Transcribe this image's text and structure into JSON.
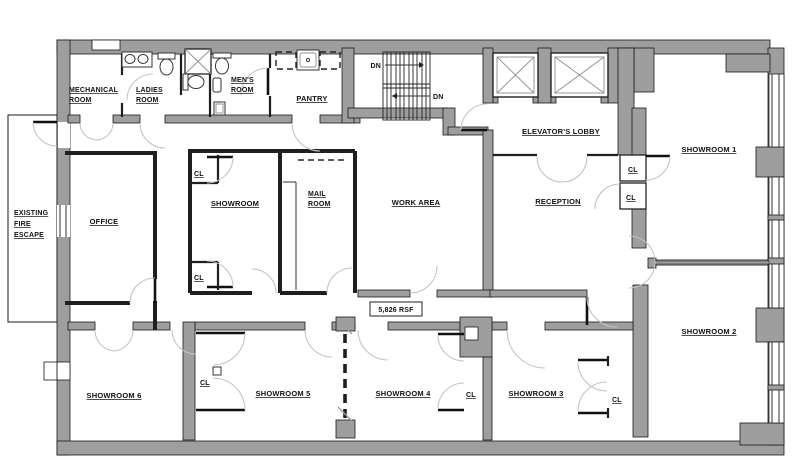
{
  "plan": {
    "area_label": "5,826 RSF",
    "closet_label": "CL",
    "stairs_down_label": "DN",
    "rooms": {
      "mechanical": [
        "MECHANICAL",
        "ROOM"
      ],
      "ladies": [
        "LADIES",
        "ROOM"
      ],
      "mens": [
        "MEN'S",
        "ROOM"
      ],
      "pantry": "PANTRY",
      "elevator_lobby": "ELEVATOR'S LOBBY",
      "showroom1": "SHOWROOM 1",
      "showroom2": "SHOWROOM 2",
      "showroom3": "SHOWROOM 3",
      "showroom4": "SHOWROOM 4",
      "showroom5": "SHOWROOM 5",
      "showroom6": "SHOWROOM 6",
      "showroom": "SHOWROOM",
      "office": "OFFICE",
      "mail": [
        "MAIL",
        "ROOM"
      ],
      "work_area": "WORK AREA",
      "reception": "RECEPTION",
      "fire_escape": [
        "EXISTING",
        "FIRE",
        "ESCAPE"
      ]
    },
    "colors": {
      "wall": "#9e9e9e",
      "partition": "#1f1f1f",
      "door_arc": "#c4c4c4"
    }
  }
}
